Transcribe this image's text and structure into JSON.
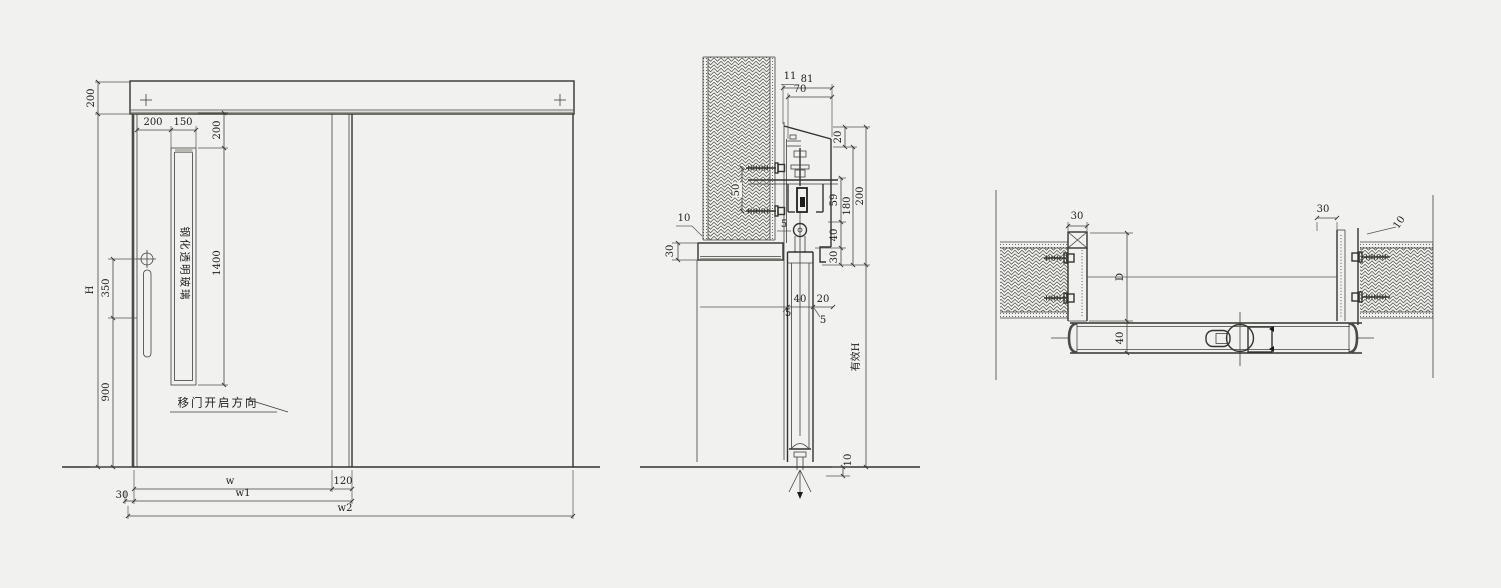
{
  "drawing": {
    "type": "sliding-door shop drawing (elevation, vertical section, horizontal section)",
    "background_color": "#f1f1ef",
    "line_color": "#3a3a38",
    "labels": {
      "elevation": {
        "header_height": "200",
        "total_height": "H",
        "dim_350": "350",
        "dim_900": "900",
        "glass_left_offset": "200",
        "glass_width": "150",
        "glass_top_offset": "200",
        "glass_height": "1400",
        "glass_note": "钢化透明玻璃",
        "open_direction": "移门开启方向",
        "width_w": "w",
        "overlap_120": "120",
        "gap_30": "30",
        "width_w1": "w1",
        "width_w2": "w2"
      },
      "section": {
        "dim_11": "11",
        "dim_81": "81",
        "dim_70": "70",
        "dim_20_top": "20",
        "dim_50": "50",
        "dim_10_wall": "10",
        "dim_30_lintel": "30",
        "dim_59": "59",
        "dim_40_side": "40",
        "dim_30_side": "30",
        "dim_180": "180",
        "dim_200": "200",
        "effective_height": "有效H",
        "dim_10_floor": "10",
        "dim_5_track": "5",
        "dim_40_door": "40",
        "dim_20_door": "20",
        "dim_5_left": "5",
        "dim_5_right": "5"
      },
      "plan": {
        "dim_30_left": "30",
        "depth_D": "D",
        "dim_40_thickness": "40",
        "dim_30_right": "30",
        "dim_10_gap": "10"
      }
    }
  }
}
